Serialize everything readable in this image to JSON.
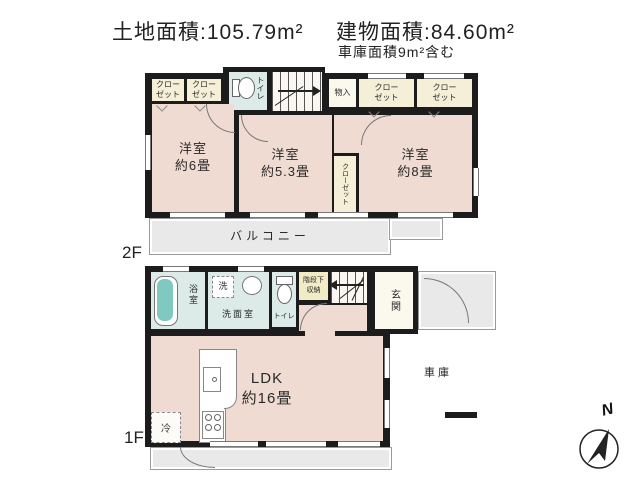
{
  "header": {
    "land_area": "土地面積:105.79m²",
    "building_area": "建物面積:84.60m²",
    "garage_note": "車庫面積9m²含む"
  },
  "floor2": {
    "label": "2F",
    "closet": "クロー\nゼット",
    "closet_vertical": "クローゼット",
    "toilet": "トイレ",
    "dn": "DN",
    "storage": "物入",
    "room_west": "洋室\n約6畳",
    "room_center": "洋室\n約5.3畳",
    "room_east": "洋室\n約8畳",
    "balcony": "バルコニー"
  },
  "floor1": {
    "label": "1F",
    "bath": "浴室",
    "washer": "洗",
    "washroom": "洗面室",
    "toilet": "トイレ",
    "under_stair_storage": "階段下\n収納",
    "up": "UP",
    "entrance": "玄関",
    "ldk": "LDK\n約16畳",
    "fridge": "冷",
    "garage": "車庫"
  },
  "compass": {
    "north": "N"
  }
}
